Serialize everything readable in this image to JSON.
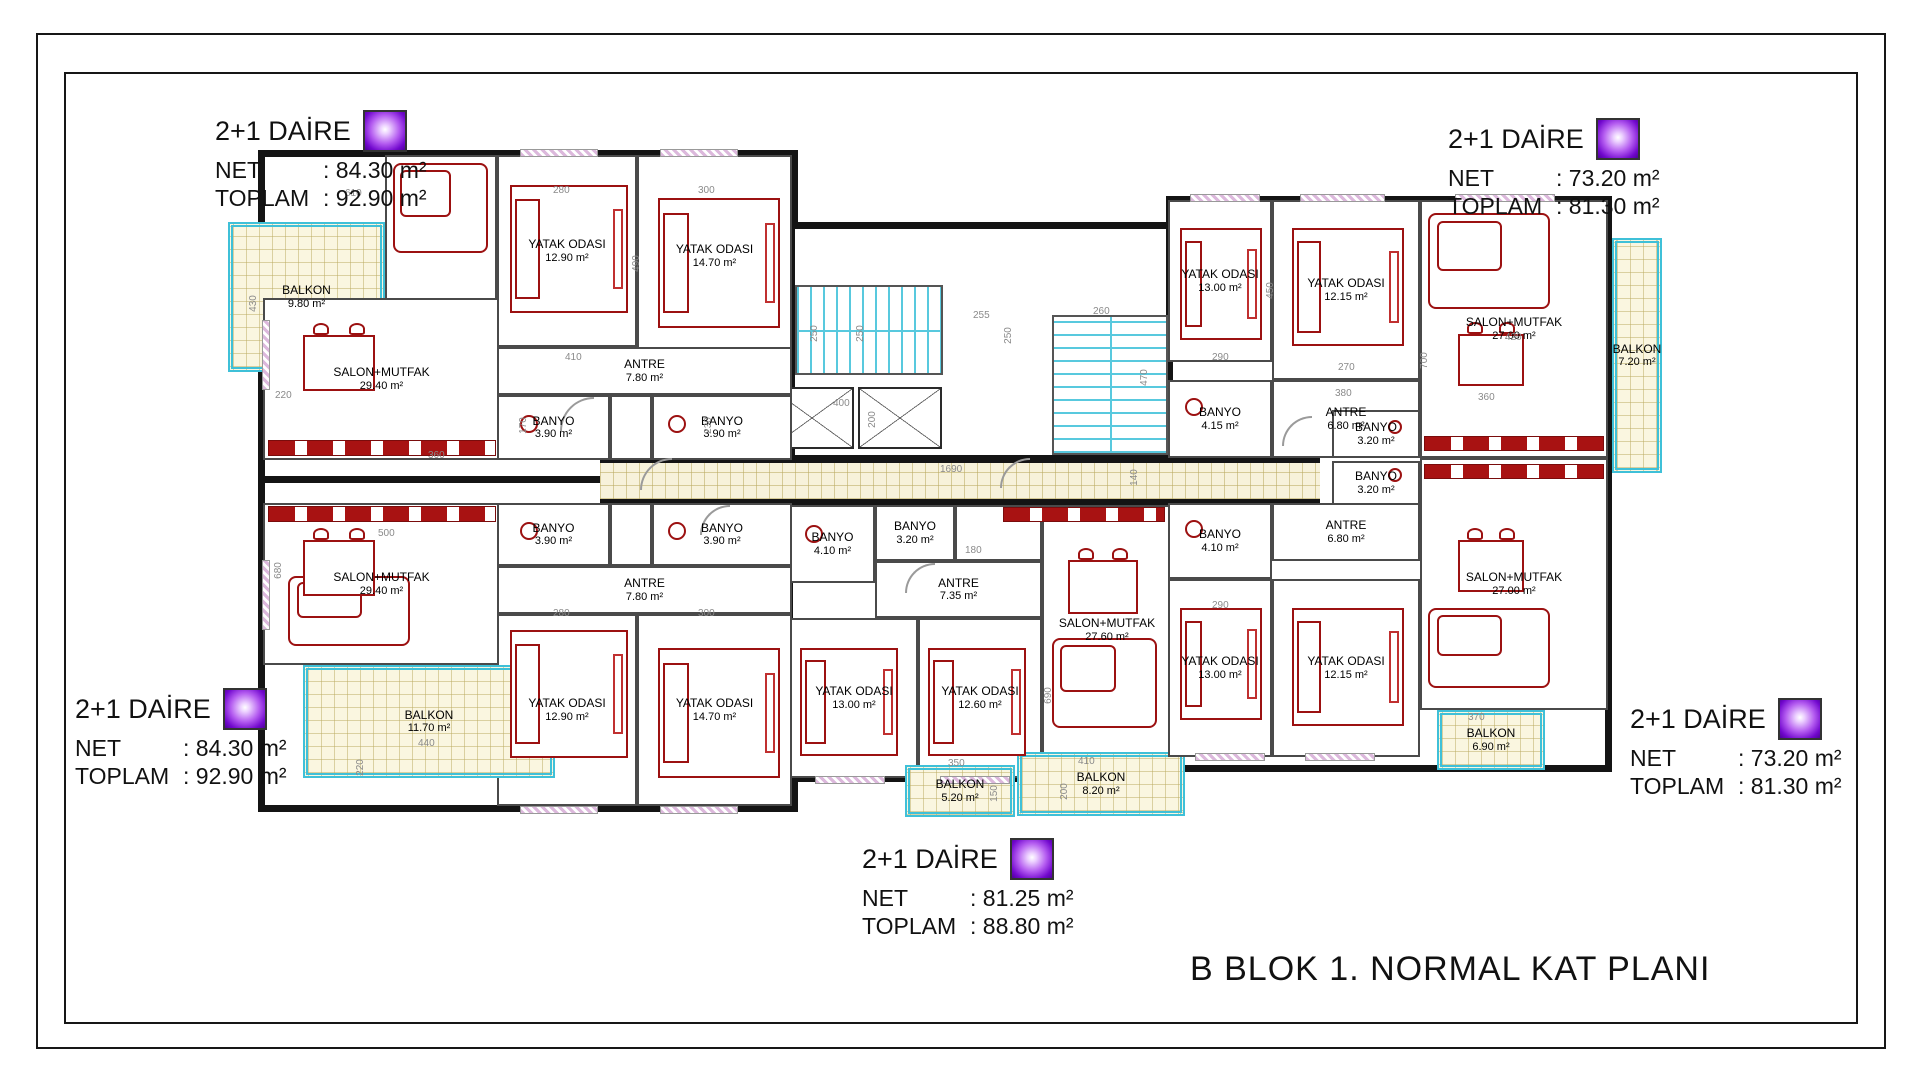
{
  "title": "B BLOK 1. NORMAL KAT PLANI",
  "units": {
    "top_left": {
      "type_label": "2+1 DAİRE",
      "net_label": "NET",
      "net_value": ": 84.30 m²",
      "toplam_label": "TOPLAM",
      "toplam_value": ": 92.90 m²"
    },
    "top_right": {
      "type_label": "2+1 DAİRE",
      "net_label": "NET",
      "net_value": ": 73.20 m²",
      "toplam_label": "TOPLAM",
      "toplam_value": ": 81.30 m²"
    },
    "bottom_left": {
      "type_label": "2+1 DAİRE",
      "net_label": "NET",
      "net_value": ": 84.30 m²",
      "toplam_label": "TOPLAM",
      "toplam_value": ": 92.90 m²"
    },
    "bottom_right": {
      "type_label": "2+1 DAİRE",
      "net_label": "NET",
      "net_value": ": 73.20 m²",
      "toplam_label": "TOPLAM",
      "toplam_value": ": 81.30 m²"
    },
    "bottom_center": {
      "type_label": "2+1 DAİRE",
      "net_label": "NET",
      "net_value": ": 81.25 m²",
      "toplam_label": "TOPLAM",
      "toplam_value": ": 88.80 m²"
    }
  },
  "rooms": {
    "balkon_tl": {
      "name": "BALKON",
      "area": "9.80 m²"
    },
    "salon_tl": {
      "name": "SALON+MUTFAK",
      "area": "29.40 m²"
    },
    "yatak_tl_1": {
      "name": "YATAK ODASI",
      "area": "12.90 m²"
    },
    "yatak_tl_2": {
      "name": "YATAK ODASI",
      "area": "14.70 m²"
    },
    "antre_tl": {
      "name": "ANTRE",
      "area": "7.80 m²"
    },
    "banyo_tl_a": {
      "name": "BANYO",
      "area": "3.90 m²"
    },
    "banyo_tl_b": {
      "name": "BANYO",
      "area": "3.90 m²"
    },
    "salon_bl": {
      "name": "SALON+MUTFAK",
      "area": "29.40 m²"
    },
    "yatak_bl_1": {
      "name": "YATAK ODASI",
      "area": "12.90 m²"
    },
    "yatak_bl_2": {
      "name": "YATAK ODASI",
      "area": "14.70 m²"
    },
    "antre_bl": {
      "name": "ANTRE",
      "area": "7.80 m²"
    },
    "banyo_bl_a": {
      "name": "BANYO",
      "area": "3.90 m²"
    },
    "banyo_bl_b": {
      "name": "BANYO",
      "area": "3.90 m²"
    },
    "balkon_bl": {
      "name": "BALKON",
      "area": "11.70 m²"
    },
    "salon_bc": {
      "name": "SALON+MUTFAK",
      "area": "27.60 m²"
    },
    "yatak_bc_1": {
      "name": "YATAK ODASI",
      "area": "13.00 m²"
    },
    "yatak_bc_2": {
      "name": "YATAK ODASI",
      "area": "12.60 m²"
    },
    "antre_bc": {
      "name": "ANTRE",
      "area": "7.35 m²"
    },
    "banyo_bc_a": {
      "name": "BANYO",
      "area": "4.10 m²"
    },
    "banyo_bc_b": {
      "name": "BANYO",
      "area": "3.20 m²"
    },
    "balkon_bc_a": {
      "name": "BALKON",
      "area": "5.20 m²"
    },
    "balkon_bc_b": {
      "name": "BALKON",
      "area": "8.20 m²"
    },
    "yatak_tr_1": {
      "name": "YATAK ODASI",
      "area": "13.00 m²"
    },
    "yatak_tr_2": {
      "name": "YATAK ODASI",
      "area": "12.15 m²"
    },
    "salon_tr": {
      "name": "SALON+MUTFAK",
      "area": "27.00 m²"
    },
    "antre_tr": {
      "name": "ANTRE",
      "area": "6.80 m²"
    },
    "banyo_tr_a": {
      "name": "BANYO",
      "area": "4.15 m²"
    },
    "banyo_tr_b": {
      "name": "BANYO",
      "area": "3.20 m²"
    },
    "balkon_tr": {
      "name": "BALKON",
      "area": "7.20 m²"
    },
    "yatak_br_1": {
      "name": "YATAK ODASI",
      "area": "13.00 m²"
    },
    "yatak_br_2": {
      "name": "YATAK ODASI",
      "area": "12.15 m²"
    },
    "salon_br": {
      "name": "SALON+MUTFAK",
      "area": "27.00 m²"
    },
    "antre_br": {
      "name": "ANTRE",
      "area": "6.80 m²"
    },
    "banyo_br_a": {
      "name": "BANYO",
      "area": "4.10 m²"
    },
    "banyo_br_b": {
      "name": "BANYO",
      "area": "3.20 m²"
    },
    "balkon_br": {
      "name": "BALKON",
      "area": "6.90 m²"
    }
  },
  "dims": [
    "610",
    "280",
    "300",
    "490",
    "430",
    "220",
    "410",
    "230",
    "170",
    "500",
    "680",
    "360",
    "250",
    "250",
    "400",
    "200",
    "255",
    "250",
    "260",
    "470",
    "1690",
    "140",
    "290",
    "450",
    "270",
    "380",
    "700",
    "420",
    "360",
    "290",
    "280",
    "300",
    "350",
    "150",
    "410",
    "200",
    "440",
    "220",
    "690",
    "370",
    "180"
  ]
}
